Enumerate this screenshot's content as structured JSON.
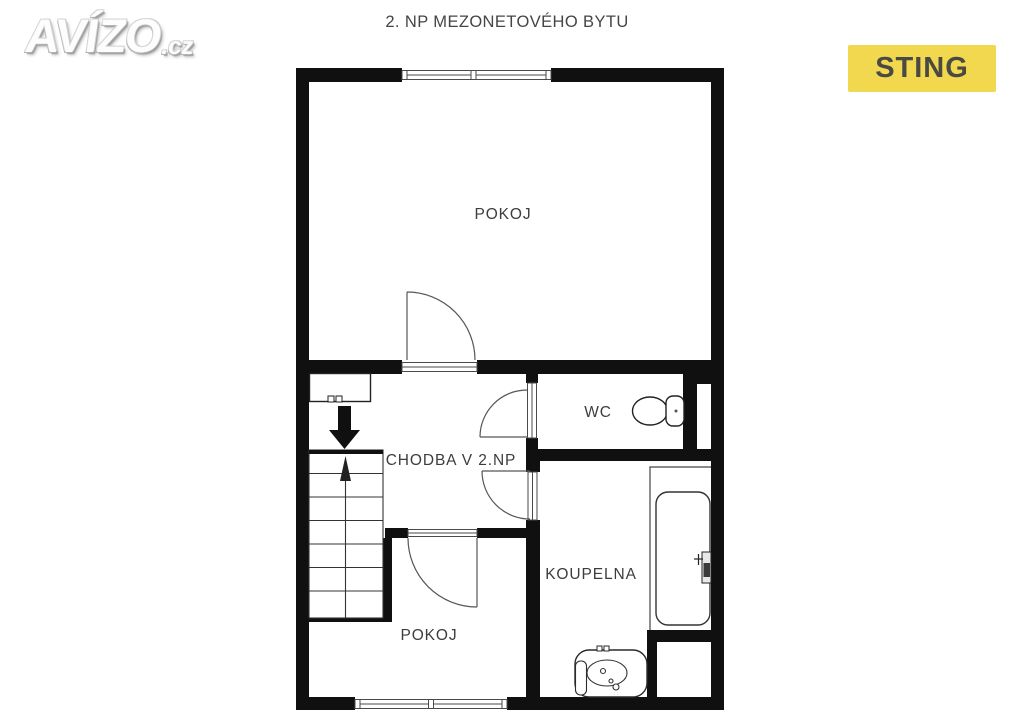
{
  "branding": {
    "logo_text": "AVÍZO",
    "logo_suffix": ".cz",
    "agency_badge": "STING",
    "badge_bg_color": "#F1D84E",
    "badge_text_color": "#4A4943"
  },
  "plan": {
    "title": "2. NP MEZONETOVÉHO BYTU",
    "rooms": [
      {
        "id": "pokoj-top",
        "label": "POKOJ"
      },
      {
        "id": "chodba",
        "label": "CHODBA V 2.NP"
      },
      {
        "id": "wc",
        "label": "WC"
      },
      {
        "id": "koupelna",
        "label": "KOUPELNA"
      },
      {
        "id": "pokoj-bottom",
        "label": "POKOJ"
      }
    ],
    "fixtures": [
      {
        "id": "staircase",
        "description": "stair flight with up-direction arrow"
      },
      {
        "id": "entry-arrow",
        "description": "thick black arrow pointing down to stairs"
      },
      {
        "id": "toilet",
        "room": "WC"
      },
      {
        "id": "bathtub",
        "room": "KOUPELNA"
      },
      {
        "id": "washbasin",
        "room": "KOUPELNA"
      }
    ],
    "colors": {
      "wall": "#101010",
      "label_text": "#3D3D3D",
      "line": "#4A4A4A"
    }
  }
}
